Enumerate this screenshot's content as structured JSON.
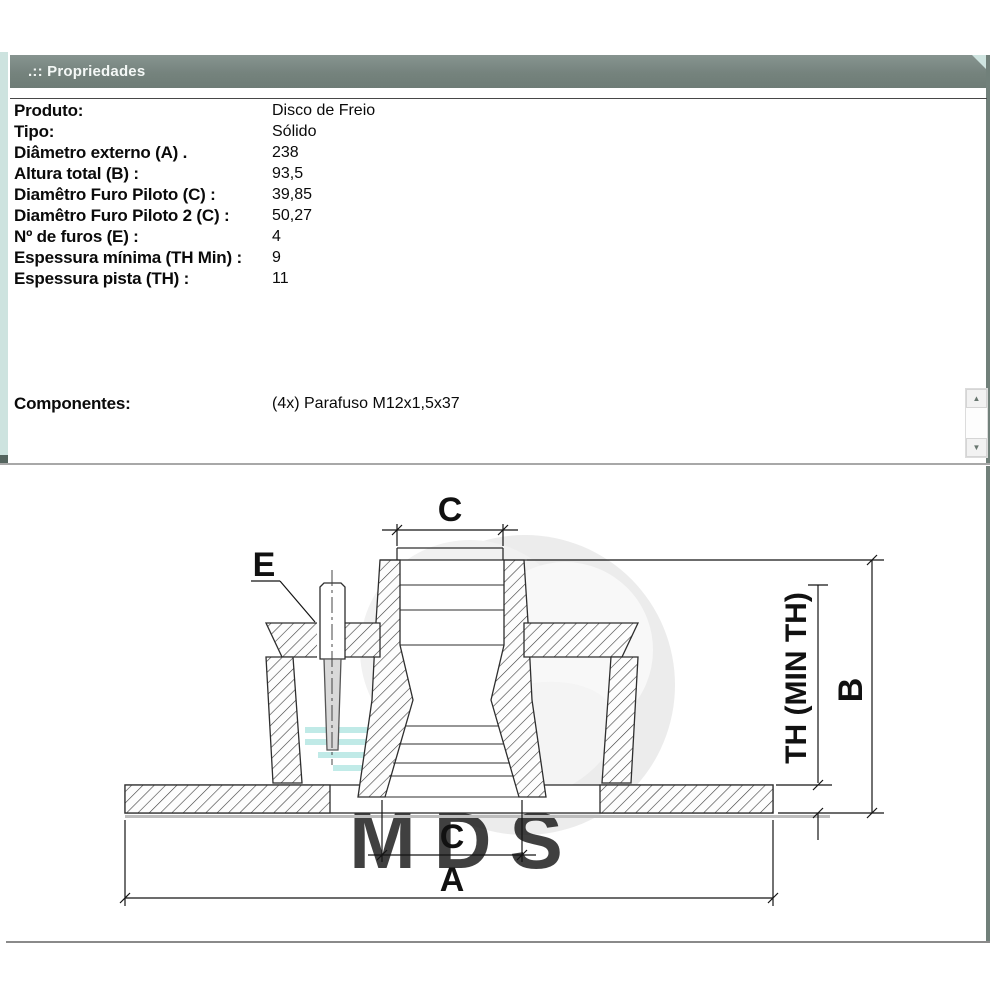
{
  "window": {
    "title": ".:: Propriedades"
  },
  "properties": {
    "rows": [
      {
        "label": "Produto:",
        "value": "Disco de Freio"
      },
      {
        "label": "Tipo:",
        "value": "Sólido"
      },
      {
        "label": "Diâmetro externo (A) .",
        "value": "238"
      },
      {
        "label": "Altura total (B) :",
        "value": "93,5"
      },
      {
        "label": "Diamêtro Furo Piloto (C) :",
        "value": "39,85"
      },
      {
        "label": "Diamêtro Furo Piloto 2 (C) :",
        "value": "50,27"
      },
      {
        "label": "Nº de furos (E) :",
        "value": "4"
      },
      {
        "label": "Espessura mínima (TH Min) :",
        "value": "9"
      },
      {
        "label": "Espessura pista (TH) :",
        "value": "11"
      }
    ],
    "components": {
      "label": "Componentes:",
      "value": "(4x) Parafuso M12x1,5x37"
    }
  },
  "scrollbar": {
    "up": "▲",
    "down": "▼"
  },
  "diagram": {
    "labels": {
      "pilot_top": "C",
      "bolt": "E",
      "thickness": "TH (MIN TH)",
      "height": "B",
      "pilot_bottom": "C",
      "outer": "A"
    },
    "watermark": {
      "text": "MDS",
      "color": "#a9e7e2"
    }
  }
}
